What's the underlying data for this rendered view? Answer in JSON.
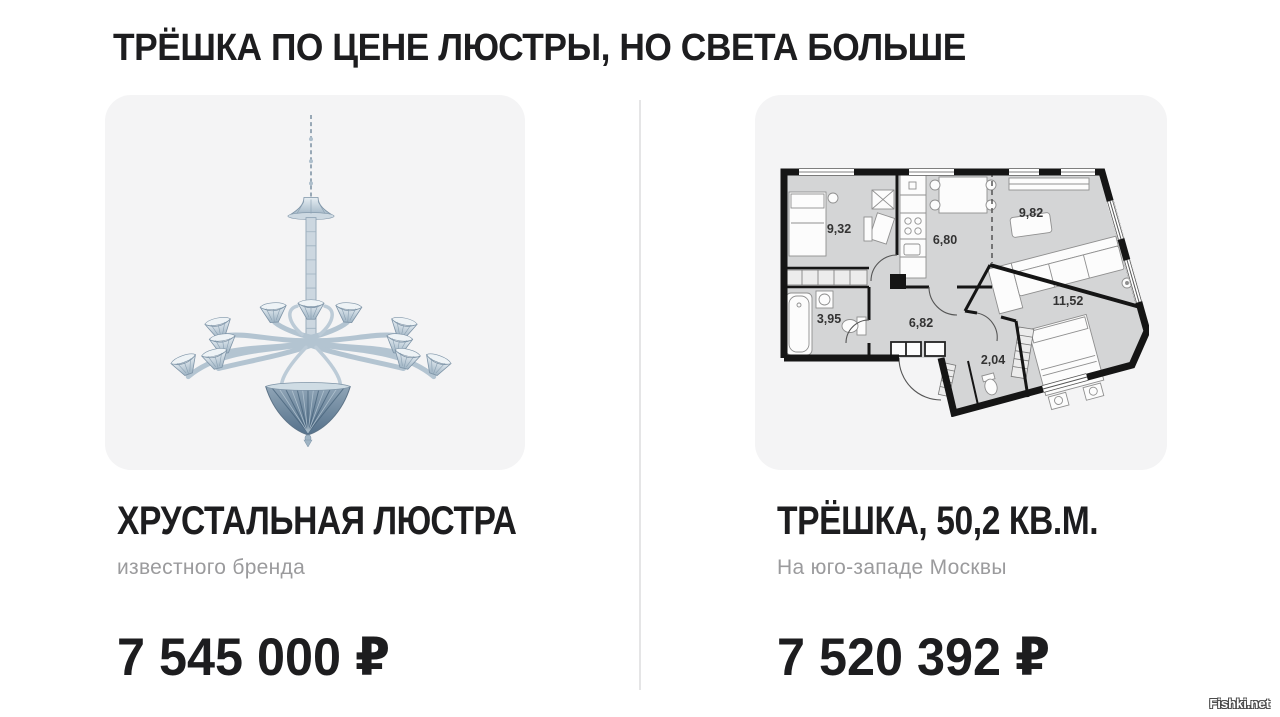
{
  "title": "ТРЁШКА ПО ЦЕНЕ ЛЮСТРЫ, НО СВЕТА БОЛЬШЕ",
  "watermark": "Fishki.net",
  "left_card": {
    "image": "crystal-chandelier-illustration",
    "title": "ХРУСТАЛЬНАЯ ЛЮСТРА",
    "subtitle": "известного бренда",
    "price": "7 545 000 ₽"
  },
  "right_card": {
    "image": "three-room-apartment-floor-plan",
    "title": "ТРЁШКА, 50,2 КВ.М.",
    "subtitle": "На юго-западе Москвы",
    "price": "7 520 392 ₽",
    "floor_plan": {
      "rooms": [
        "9,32",
        "6,80",
        "9,82",
        "11,52",
        "3,95",
        "6,82",
        "2,04"
      ]
    }
  },
  "colors": {
    "page_bg": "#ffffff",
    "card_bg": "#f4f4f5",
    "divider": "#e5e5e6",
    "text_dark": "#1d1d1f",
    "text_gray": "#9b9b9d",
    "plan_room_fill": "#d4d5d6",
    "plan_wall": "#151515",
    "chandelier_light": "#ccd9e2",
    "chandelier_mid": "#b0c2cf",
    "chandelier_dark": "#5a7388"
  }
}
